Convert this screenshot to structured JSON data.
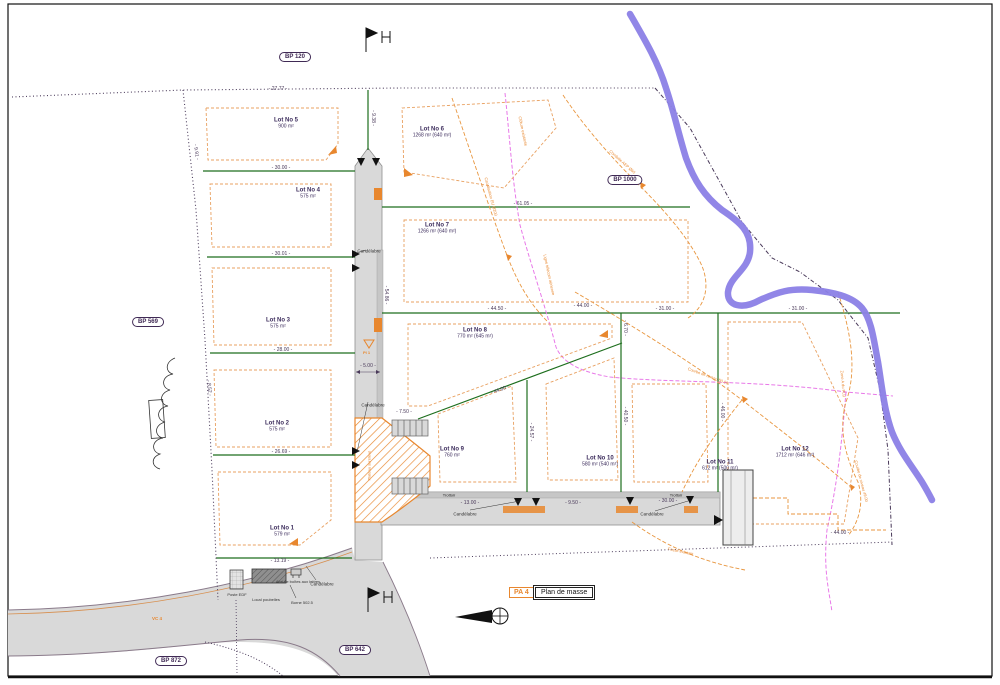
{
  "sheet": {
    "code": "PA 4",
    "title": "Plan de masse"
  },
  "refs": {
    "bp120": "BP 120",
    "bp1000": "BP 1000",
    "bp569": "BP 569",
    "bp642": "BP 642",
    "bp872": "BP 872",
    "vc": "VC 4"
  },
  "lots": [
    {
      "name": "Lot No 1",
      "area": "579 m²"
    },
    {
      "name": "Lot No 2",
      "area": "575 m²"
    },
    {
      "name": "Lot No 3",
      "area": "575 m²"
    },
    {
      "name": "Lot No 4",
      "area": "575 m²"
    },
    {
      "name": "Lot No 5",
      "area": "900 m²"
    },
    {
      "name": "Lot No 6",
      "area": "1268 m² (640 m²)"
    },
    {
      "name": "Lot No 7",
      "area": "1266 m² (640 m²)"
    },
    {
      "name": "Lot No 8",
      "area": "770 m² (645 m²)"
    },
    {
      "name": "Lot No 9",
      "area": "760 m²"
    },
    {
      "name": "Lot No 10",
      "area": "580 m² (540 m²)"
    },
    {
      "name": "Lot No 11",
      "area": "612 m² (500 m²)"
    },
    {
      "name": "Lot No 12",
      "area": "1712 m² (646 m²)"
    }
  ],
  "dims": [
    "27.77",
    "30.00",
    "30.01",
    "28.00",
    "26.69",
    "13.19",
    "61.05",
    "44.50",
    "44.00",
    "31.00",
    "31.00",
    "44.00",
    "13.00",
    "9.50",
    "30.00",
    "9.38",
    "44.00",
    "24.57",
    "6.70",
    "40.50",
    "46.00",
    "7.50",
    "5.00",
    "54.86",
    "9.91",
    "8.52"
  ],
  "labels": {
    "trottoir": "Trottoir",
    "candelabre": "Candélabre",
    "poste_edf": "Poste EDF",
    "local_poubelles": "Local poubelles",
    "abri": "Abri de boîtes aux lettres",
    "borne": "Borne 502.5",
    "pi": "PI 1",
    "plateau": "Plateau surélevé"
  },
  "networks": [
    "Canalisation EU Ø200",
    "Conduite AEP Ø60",
    "Ligne télécom aérienne",
    "Courbe de niveau 50.00",
    "Zone A du PLU",
    "Courbe de niveau 49.00",
    "Fossé existant",
    "Clôture existante"
  ],
  "colors": {
    "road": "#d9d9d9",
    "sidewalk": "#c6c6c6",
    "green": "#1d6e1d",
    "orange": "#e8872e",
    "lot_dash": "#e8a060",
    "river": "#8b80e6",
    "magenta": "#e879e8",
    "boundary": "#4a3a5a",
    "lot_text": "#3c2c5c"
  }
}
